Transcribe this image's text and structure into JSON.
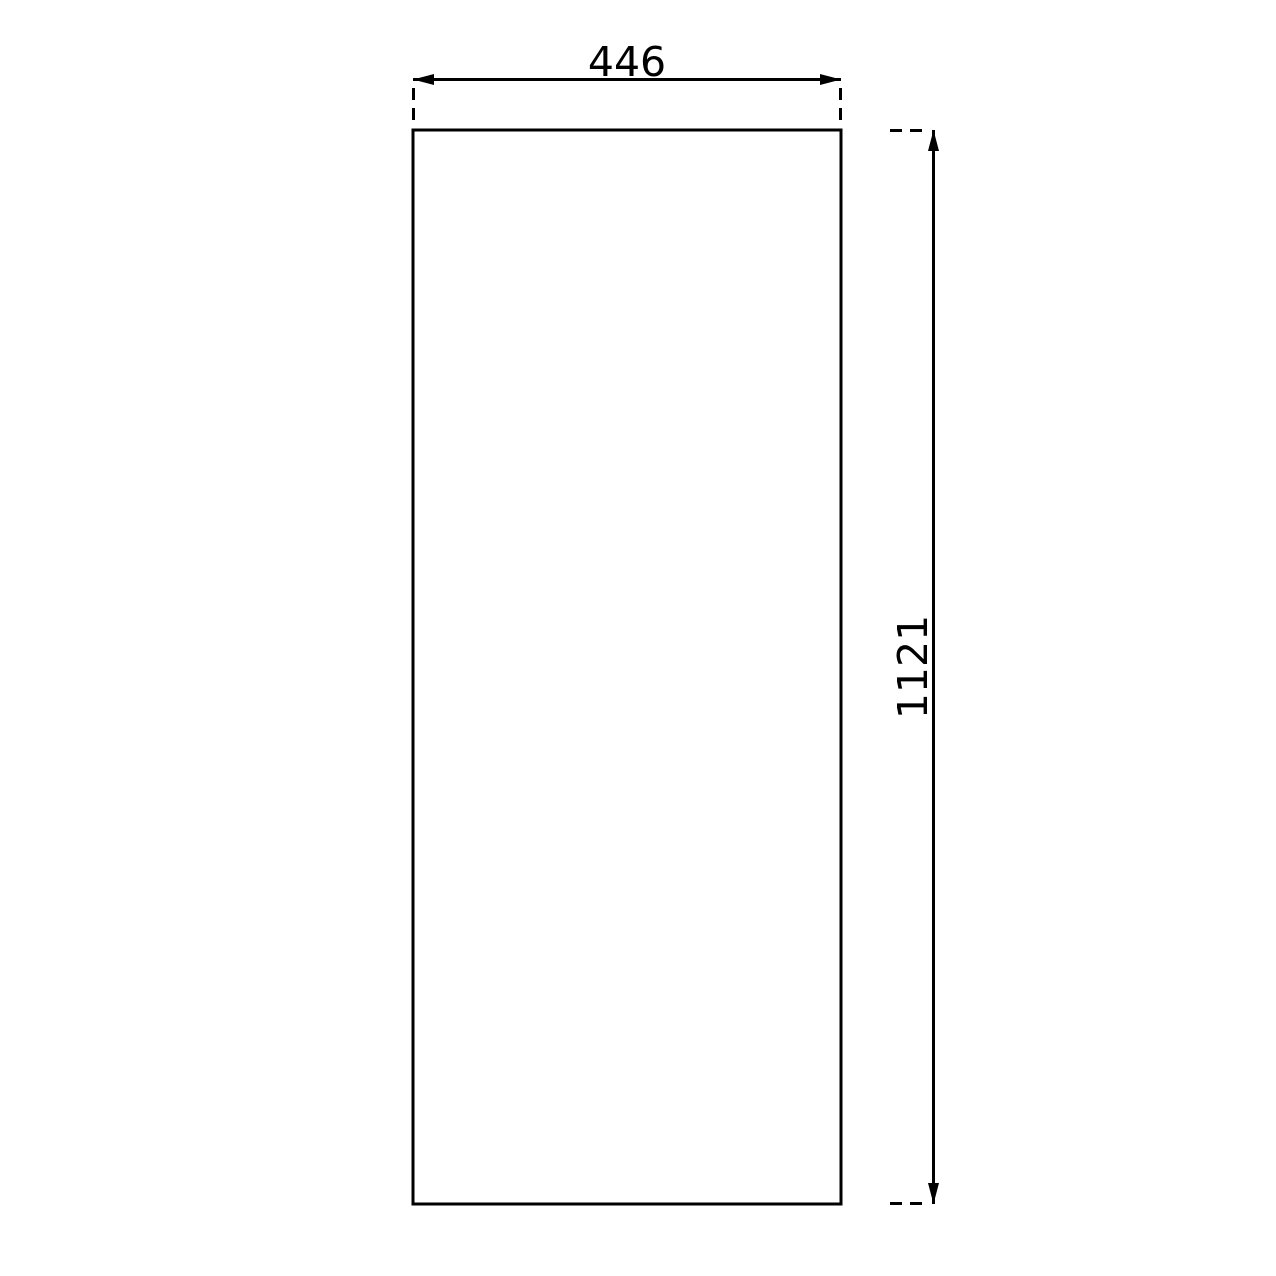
{
  "page": {
    "background_color": "#ffffff",
    "line_color": "#000000"
  },
  "drawing": {
    "type": "technical-dimension-drawing",
    "shape": "rectangle",
    "width_dim": {
      "label": "446",
      "value": 446,
      "orientation": "horizontal",
      "position": "top"
    },
    "height_dim": {
      "label": "1121",
      "value": 1121,
      "orientation": "vertical",
      "position": "right",
      "text_rotation_deg": -90
    }
  }
}
